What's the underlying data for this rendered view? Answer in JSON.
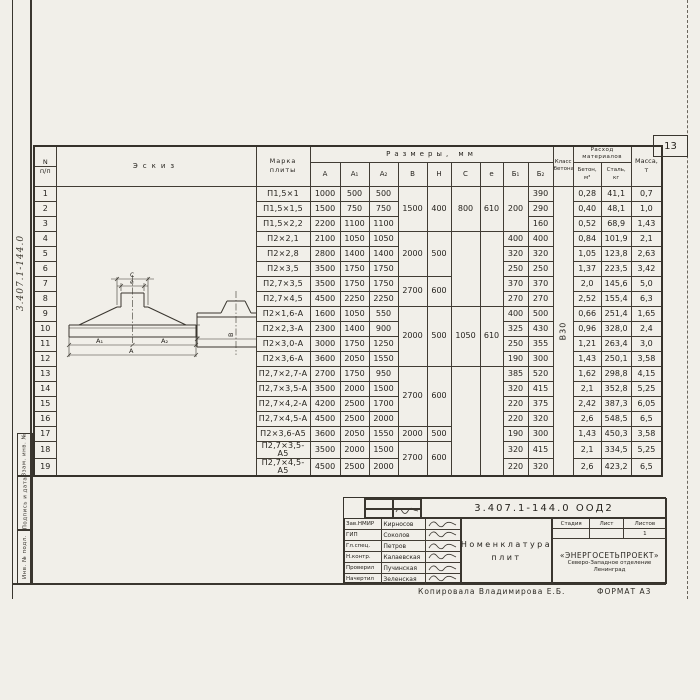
{
  "page": {
    "number": "13",
    "margin_code": "3.407.1-144.0",
    "copied_by": "Копировала Владимирова Е.Б.",
    "format_note": "ФОРМАТ А3"
  },
  "margin_boxes": [
    "Взам. инв. №",
    "Подпись и дата",
    "Инв. № подл."
  ],
  "table": {
    "header": {
      "num": [
        "N",
        "п/п"
      ],
      "sketch": "Эскиз",
      "mark": [
        "Марка",
        "плиты"
      ],
      "dims_group": "Размеры, мм",
      "dims": [
        "А",
        "А₁",
        "А₂",
        "В",
        "Н",
        "С",
        "е",
        "Б₁",
        "Б₂"
      ],
      "concrete_class": [
        "Класс",
        "бетона"
      ],
      "consumption_group": [
        "Расход",
        "материалов"
      ],
      "consumption": [
        [
          "Бетон,",
          "м³"
        ],
        [
          "Сталь,",
          "кг"
        ]
      ],
      "mass": [
        "Масса,",
        "т"
      ]
    },
    "rows": [
      {
        "n": "1",
        "mark": "П1,5×1",
        "A": "1000",
        "A1": "500",
        "A2": "500",
        "B1": "",
        "B2": "390",
        "concrete": "0,28",
        "steel": "41,1",
        "mass": "0,7"
      },
      {
        "n": "2",
        "mark": "П1,5×1,5",
        "A": "1500",
        "A1": "750",
        "A2": "750",
        "B1": "",
        "B2": "290",
        "concrete": "0,40",
        "steel": "48,1",
        "mass": "1,0"
      },
      {
        "n": "3",
        "mark": "П1,5×2,2",
        "A": "2200",
        "A1": "1100",
        "A2": "1100",
        "B1": "",
        "B2": "160",
        "concrete": "0,52",
        "steel": "68,9",
        "mass": "1,43"
      },
      {
        "n": "4",
        "mark": "П2×2,1",
        "A": "2100",
        "A1": "1050",
        "A2": "1050",
        "B1": "400",
        "B2": "400",
        "concrete": "0,84",
        "steel": "101,9",
        "mass": "2,1"
      },
      {
        "n": "5",
        "mark": "П2×2,8",
        "A": "2800",
        "A1": "1400",
        "A2": "1400",
        "B1": "320",
        "B2": "320",
        "concrete": "1,05",
        "steel": "123,8",
        "mass": "2,63"
      },
      {
        "n": "6",
        "mark": "П2×3,5",
        "A": "3500",
        "A1": "1750",
        "A2": "1750",
        "B1": "250",
        "B2": "250",
        "concrete": "1,37",
        "steel": "223,5",
        "mass": "3,42"
      },
      {
        "n": "7",
        "mark": "П2,7×3,5",
        "A": "3500",
        "A1": "1750",
        "A2": "1750",
        "B1": "370",
        "B2": "370",
        "concrete": "2,0",
        "steel": "145,6",
        "mass": "5,0"
      },
      {
        "n": "8",
        "mark": "П2,7×4,5",
        "A": "4500",
        "A1": "2250",
        "A2": "2250",
        "B1": "270",
        "B2": "270",
        "concrete": "2,52",
        "steel": "155,4",
        "mass": "6,3"
      },
      {
        "n": "9",
        "mark": "П2×1,6-А",
        "A": "1600",
        "A1": "1050",
        "A2": "550",
        "B1": "400",
        "B2": "500",
        "concrete": "0,66",
        "steel": "251,4",
        "mass": "1,65"
      },
      {
        "n": "10",
        "mark": "П2×2,3-А",
        "A": "2300",
        "A1": "1400",
        "A2": "900",
        "B1": "325",
        "B2": "430",
        "concrete": "0,96",
        "steel": "328,0",
        "mass": "2,4"
      },
      {
        "n": "11",
        "mark": "П2×3,0-А",
        "A": "3000",
        "A1": "1750",
        "A2": "1250",
        "B1": "250",
        "B2": "355",
        "concrete": "1,21",
        "steel": "263,4",
        "mass": "3,0"
      },
      {
        "n": "12",
        "mark": "П2×3,6-А",
        "A": "3600",
        "A1": "2050",
        "A2": "1550",
        "B1": "190",
        "B2": "300",
        "concrete": "1,43",
        "steel": "250,1",
        "mass": "3,58"
      },
      {
        "n": "13",
        "mark": "П2,7×2,7-А",
        "A": "2700",
        "A1": "1750",
        "A2": "950",
        "B1": "385",
        "B2": "520",
        "concrete": "1,62",
        "steel": "298,8",
        "mass": "4,15"
      },
      {
        "n": "14",
        "mark": "П2,7×3,5-А",
        "A": "3500",
        "A1": "2000",
        "A2": "1500",
        "B1": "320",
        "B2": "415",
        "concrete": "2,1",
        "steel": "352,8",
        "mass": "5,25"
      },
      {
        "n": "15",
        "mark": "П2,7×4,2-А",
        "A": "4200",
        "A1": "2500",
        "A2": "1700",
        "B1": "220",
        "B2": "375",
        "concrete": "2,42",
        "steel": "387,3",
        "mass": "6,05"
      },
      {
        "n": "16",
        "mark": "П2,7×4,5-А",
        "A": "4500",
        "A1": "2500",
        "A2": "2000",
        "B1": "220",
        "B2": "320",
        "concrete": "2,6",
        "steel": "548,5",
        "mass": "6,5"
      },
      {
        "n": "17",
        "mark": "П2×3,6-А5",
        "A": "3600",
        "A1": "2050",
        "A2": "1550",
        "B1": "190",
        "B2": "300",
        "concrete": "1,43",
        "steel": "450,3",
        "mass": "3,58"
      },
      {
        "n": "18",
        "mark": "П2,7×3,5-А5",
        "A": "3500",
        "A1": "2000",
        "A2": "1500",
        "B1": "320",
        "B2": "415",
        "concrete": "2,1",
        "steel": "334,5",
        "mass": "5,25"
      },
      {
        "n": "19",
        "mark": "П2,7×4,5-А5",
        "A": "4500",
        "A1": "2500",
        "A2": "2000",
        "B1": "220",
        "B2": "320",
        "concrete": "2,6",
        "steel": "423,2",
        "mass": "6,5"
      }
    ],
    "merges": {
      "B": [
        {
          "from": 1,
          "to": 3,
          "v": "1500"
        },
        {
          "from": 4,
          "to": 6,
          "v": "2000"
        },
        {
          "from": 7,
          "to": 8,
          "v": "2700"
        },
        {
          "from": 9,
          "to": 12,
          "v": "2000"
        },
        {
          "from": 13,
          "to": 16,
          "v": "2700"
        },
        {
          "from": 17,
          "to": 17,
          "v": "2000"
        },
        {
          "from": 18,
          "to": 19,
          "v": "2700"
        }
      ],
      "H": [
        {
          "from": 1,
          "to": 3,
          "v": "400"
        },
        {
          "from": 4,
          "to": 6,
          "v": "500"
        },
        {
          "from": 7,
          "to": 8,
          "v": "600"
        },
        {
          "from": 9,
          "to": 12,
          "v": "500"
        },
        {
          "from": 13,
          "to": 16,
          "v": "600"
        },
        {
          "from": 17,
          "to": 17,
          "v": "500"
        },
        {
          "from": 18,
          "to": 19,
          "v": "600"
        }
      ],
      "C": [
        {
          "from": 1,
          "to": 3,
          "v": "800"
        },
        {
          "from": 4,
          "to": 8,
          "v": ""
        },
        {
          "from": 9,
          "to": 12,
          "v": "1050"
        },
        {
          "from": 13,
          "to": 19,
          "v": ""
        }
      ],
      "e": [
        {
          "from": 1,
          "to": 3,
          "v": "610"
        },
        {
          "from": 4,
          "to": 8,
          "v": ""
        },
        {
          "from": 9,
          "to": 12,
          "v": "610"
        },
        {
          "from": 13,
          "to": 19,
          "v": ""
        }
      ],
      "B1": [
        {
          "from": 1,
          "to": 3,
          "v": "200"
        }
      ],
      "concrete_class": [
        {
          "from": 1,
          "to": 19,
          "v": "В30"
        }
      ]
    }
  },
  "sketch_labels": {
    "c": "С",
    "e": "е",
    "a1": "А₁",
    "a2": "А₂",
    "a": "А",
    "b": "В",
    "flange": "100"
  },
  "title_block": {
    "doc_number": "3.407.1-144.0  ООД2",
    "signers": [
      {
        "role": "Зав.НМИР",
        "name": "Кирносов"
      },
      {
        "role": "ГИП",
        "name": "Соколов"
      },
      {
        "role": "Гл.спец.",
        "name": "Петров"
      },
      {
        "role": "Н.контр.",
        "name": "Калаевская"
      },
      {
        "role": "Проверил",
        "name": "Пучинская"
      },
      {
        "role": "Начертил",
        "name": "Зеленская"
      }
    ],
    "title_lines": [
      "Номенклатура",
      "плит"
    ],
    "stage_headers": [
      "Стадия",
      "Лист",
      "Листов"
    ],
    "sheets_value": "1",
    "org": [
      "«ЭНЕРГОСЕТЬПРОЕКТ»",
      "Северо-Западное отделение",
      "Ленинград"
    ]
  }
}
